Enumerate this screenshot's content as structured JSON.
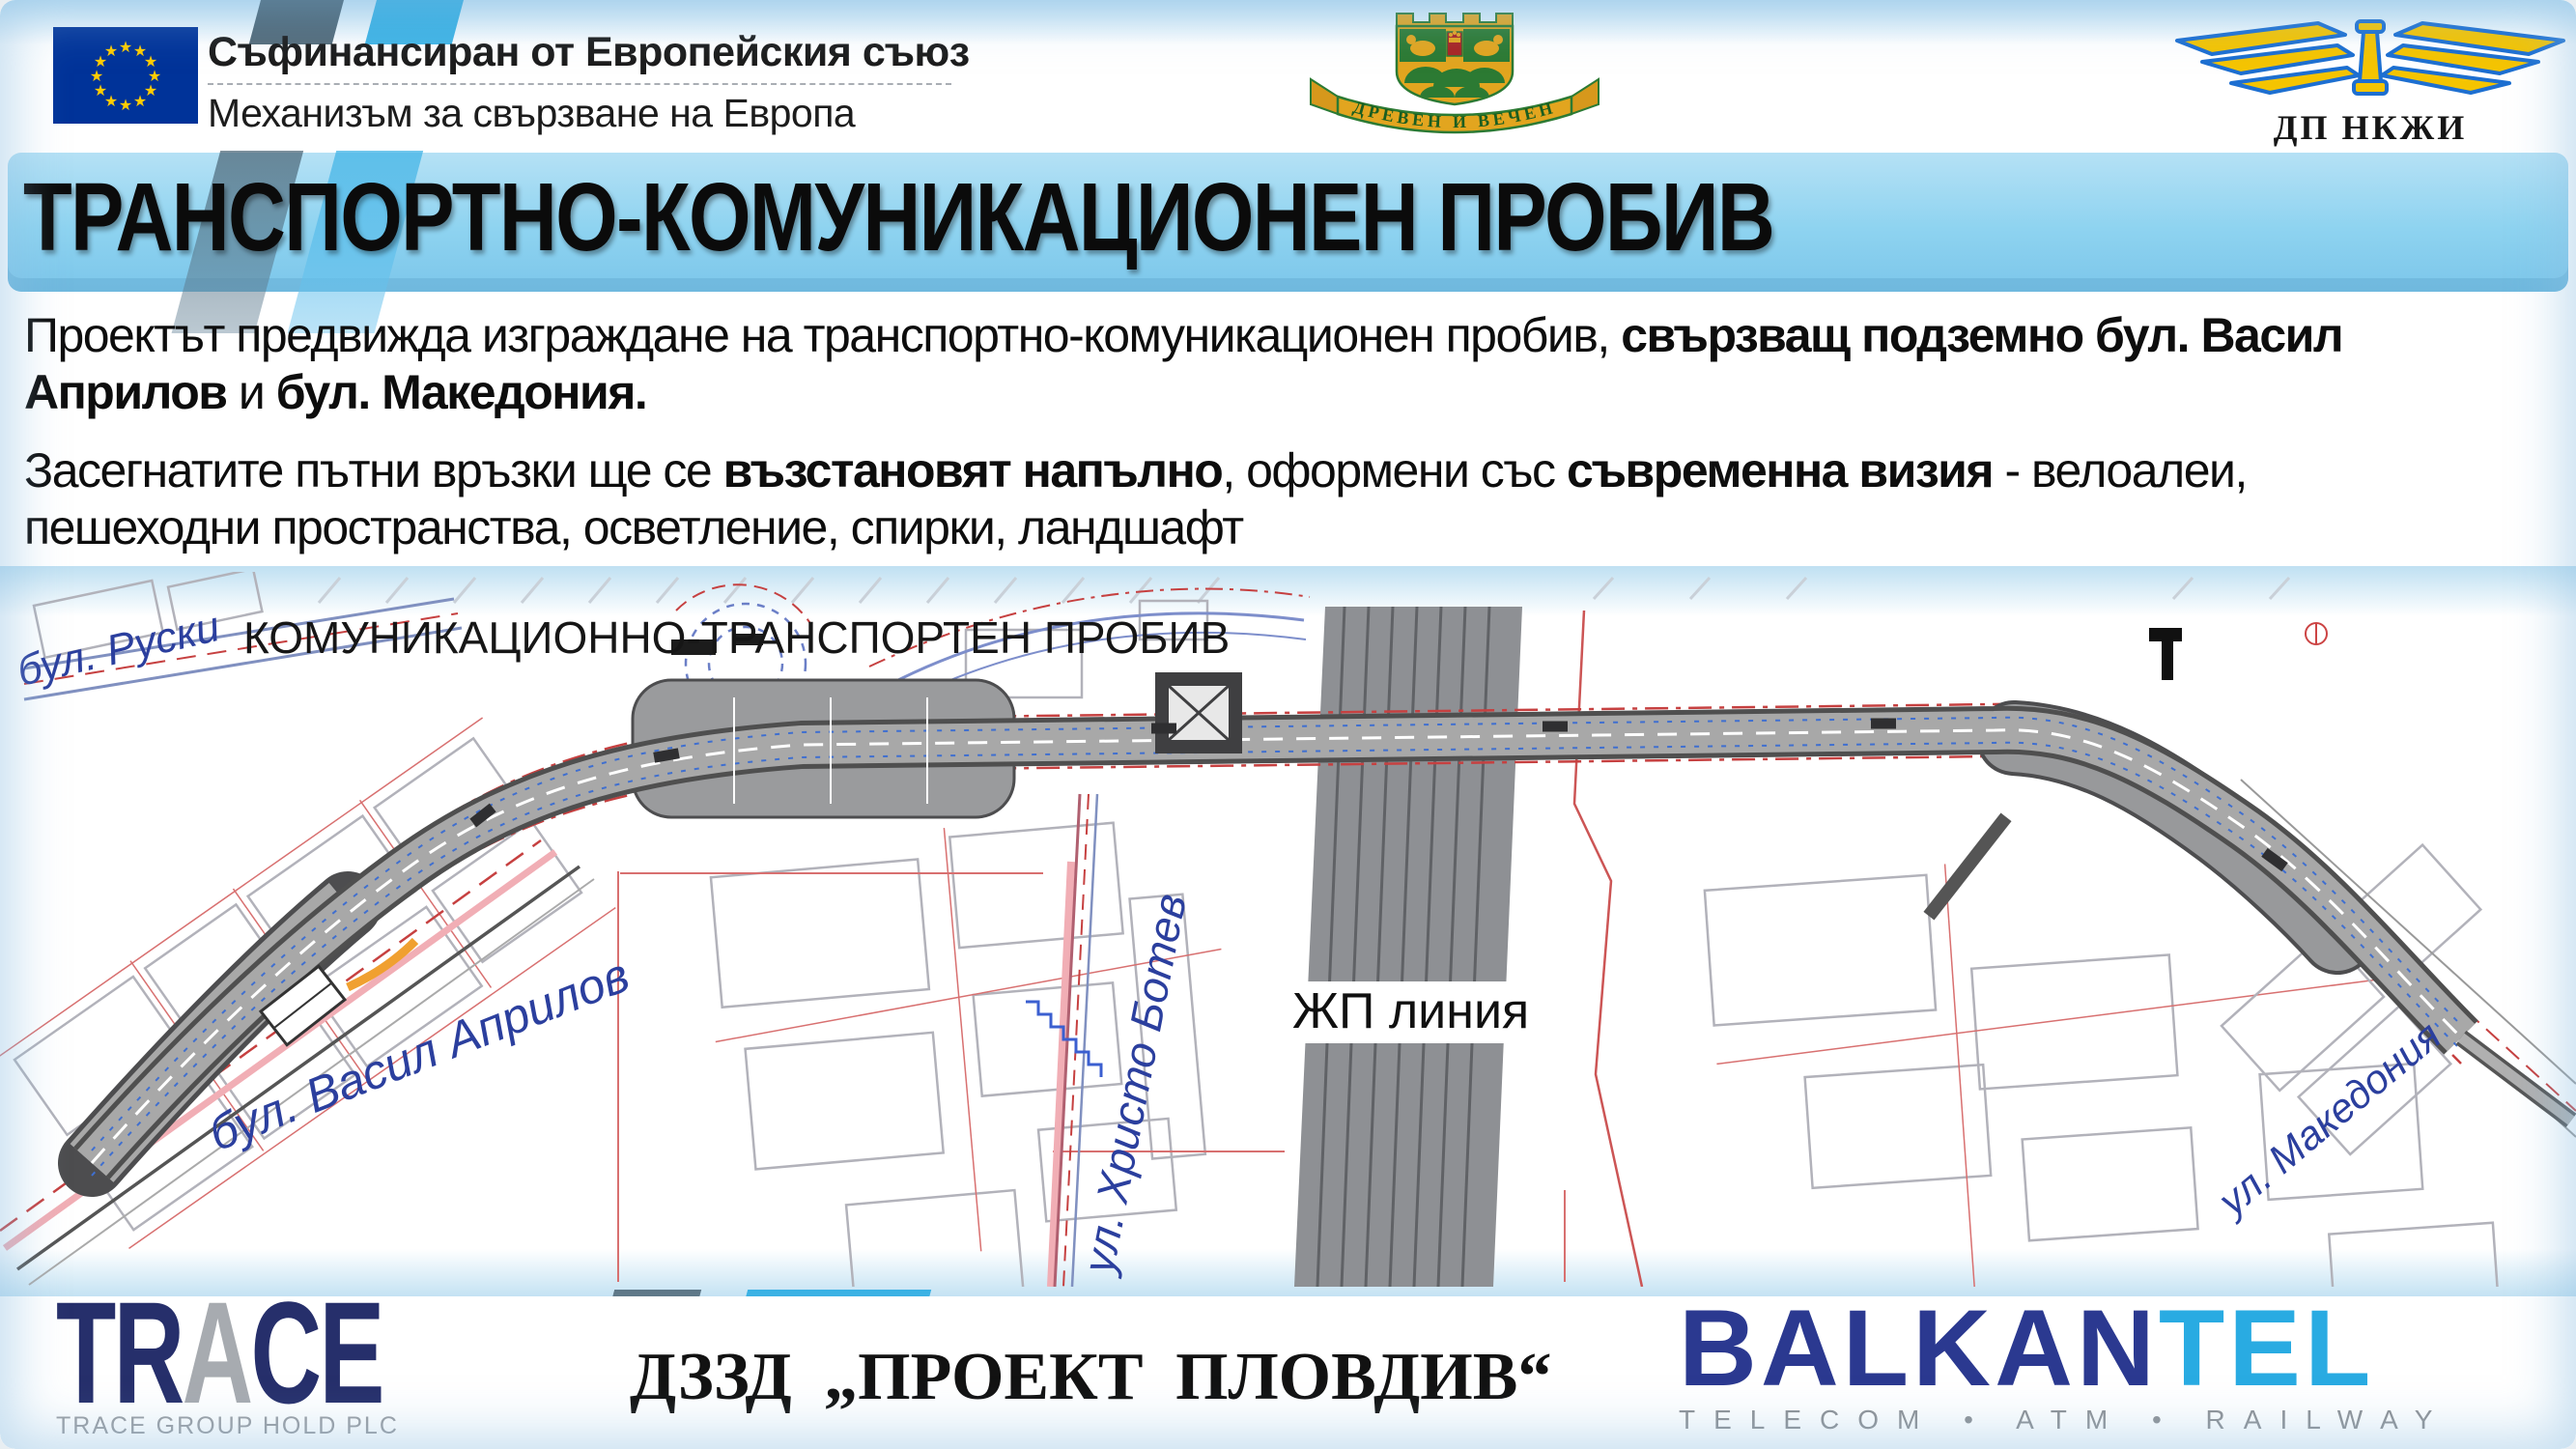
{
  "header": {
    "eu_line1": "Съфинансиран от Европейския съюз",
    "eu_line2": "Механизъм за свързване на Европа",
    "plovdiv_motto": "ДРЕВЕН И ВЕЧЕН",
    "railway_org": "ДП НКЖИ"
  },
  "title": "ТРАНСПОРТНО-КОМУНИКАЦИОНЕН ПРОБИВ",
  "body": {
    "p1": {
      "r1": "Проектът предвижда изграждане на транспортно-комуникационен пробив, ",
      "r2_bold": "свързващ подземно бул. Васил",
      "r3_bold": "Априлов",
      "r4": " и ",
      "r5_bold": "бул. Македония."
    },
    "p2": {
      "r1": "Засегнатите пътни връзки ще се ",
      "r2_bold": "възстановят напълно",
      "r3": ", оформени със ",
      "r4_bold": "съвременна визия",
      "r5": " - велоалеи,",
      "r6": "пешеходни пространства, осветление, спирки, ландшафт"
    }
  },
  "map": {
    "title": "КОМУНИКАЦИОННО-ТРАНСПОРТЕН ПРОБИВ",
    "label_ruski": "бул. Руски",
    "label_vasil_aprilov": "бул. Васил Априлов",
    "label_hristo_botev": "ул. Христо Ботев",
    "label_railway": "ЖП линия",
    "label_makedonia": "ул. Македония"
  },
  "footer": {
    "trace_tr": "TR",
    "trace_a": "A",
    "trace_ce": "CE",
    "trace_sub": "TRACE GROUP HOLD PLC",
    "consortium": "ДЗЗД „ПРОЕКТ ПЛОВДИВ“",
    "balkan": "BALKAN",
    "tel": "TEL",
    "balkantel_sub": "TELECOM • ATM • RAILWAY"
  },
  "icons": {
    "star": "★"
  },
  "colors": {
    "accent_blue": "#29abe2",
    "slate_stripe": "#4b6474",
    "title_bar_blue": "#8ed3f0",
    "trace_navy": "#262f6b",
    "balkan_navy": "#2b3990",
    "map_label_blue": "#2b3f9e",
    "eu_flag_blue": "#003399",
    "eu_star_yellow": "#ffcc00",
    "emblem_green": "#2c7a33",
    "emblem_gold": "#e2a51f",
    "railway_gray": "#8e9094"
  }
}
